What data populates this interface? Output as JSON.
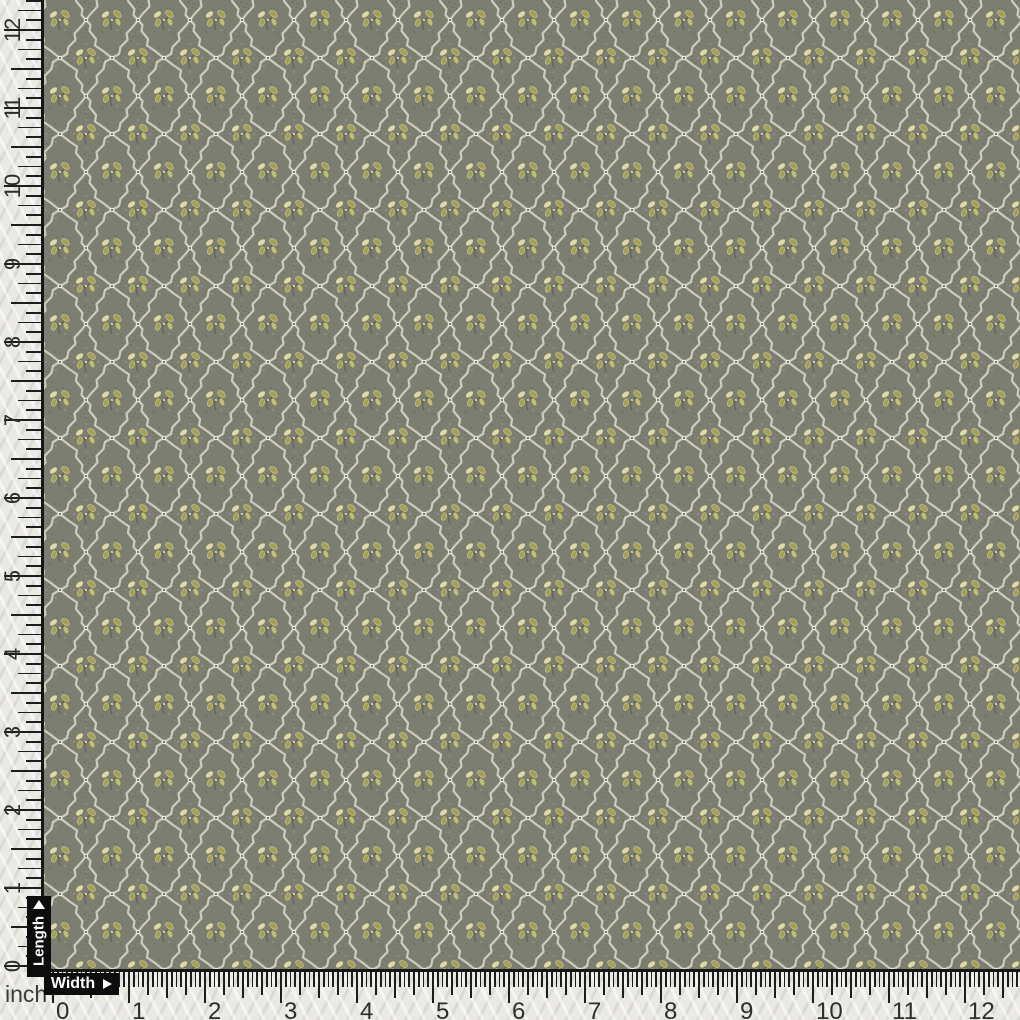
{
  "fabric": {
    "name": "olive-grey diamond lattice fabric with floral sprigs",
    "base_color": "#7c7e71",
    "lattice_color": "#d3d1c1",
    "crossing_dot_color": "#eceadb",
    "leaf_olive": "#a3a04f",
    "leaf_pale": "#c1bd7a",
    "leaf_cream": "#ddd8b4",
    "leaf_dark": "#7f7f3e",
    "stem_color": "#5e604b",
    "speckle_color": "#54564a"
  },
  "rulers": {
    "unit_label": "inch",
    "strip_color": "#eae9e4",
    "tick_color": "#1d1d1d",
    "number_color": "#2d2d2d",
    "tag_bg": "#0d0d0d",
    "tag_text_color": "#ffffff",
    "left": {
      "tag_label": "Length",
      "arrow_icon": "up-triangle",
      "divisions_per_inch": 8,
      "numbers": [
        "0",
        "1",
        "2",
        "3",
        "4",
        "5",
        "6",
        "7",
        "8",
        "9",
        "10",
        "11",
        "12"
      ]
    },
    "bottom": {
      "tag_label": "Width",
      "arrow_icon": "right-triangle",
      "divisions_per_inch": 16,
      "numbers": [
        "0",
        "1",
        "2",
        "3",
        "4",
        "5",
        "6",
        "7",
        "8",
        "9",
        "10",
        "11",
        "12"
      ]
    }
  }
}
